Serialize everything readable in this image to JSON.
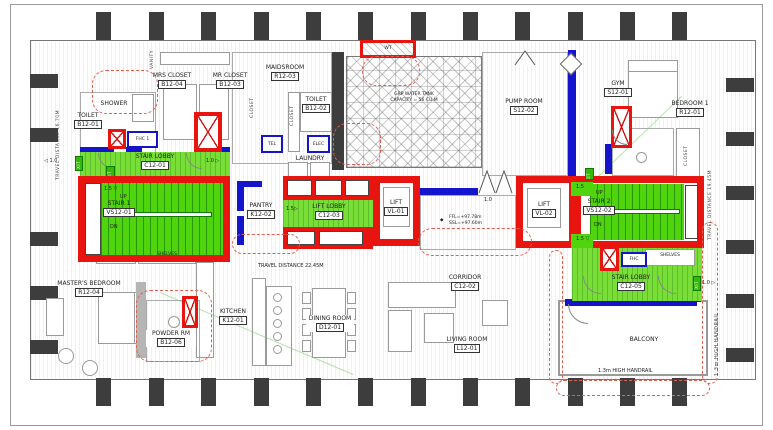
{
  "drawing_type": "residential floor plan - fire egress / life safety layout",
  "colors": {
    "core_red": "#e8140f",
    "egress_green": "#50d40e",
    "wall_blue": "#1414cc",
    "column_gray": "#3d3d3d",
    "revision_cloud_red": "#e06050"
  },
  "rooms": {
    "toilet1": {
      "name": "TOILET",
      "number": "B12-01"
    },
    "shower": {
      "name": "SHOWER"
    },
    "mrs_closet": {
      "name": "MRS CLOSET",
      "number": "B12-04"
    },
    "mr_closet": {
      "name": "MR CLOSET",
      "number": "B12-03"
    },
    "maidsroom": {
      "name": "MAIDSROOM",
      "number": "R12-03"
    },
    "toilet2": {
      "name": "TOILET",
      "number": "B12-02"
    },
    "laundry": {
      "name": "LAUNDRY"
    },
    "water_tank": {
      "line1": "GRP WATER TANK",
      "line2": "CAPACITY = 56 CU.M"
    },
    "pump_room": {
      "name": "PUMP ROOM",
      "number": "S12-02"
    },
    "gym": {
      "name": "GYM",
      "number": "S12-01"
    },
    "bedroom1": {
      "name": "BEDROOM 1",
      "number": "R12-01"
    },
    "pantry": {
      "name": "PANTRY",
      "number": "K12-02"
    },
    "lift_lobby": {
      "name": "LIFT LOBBY",
      "number": "C12-03"
    },
    "lift1": {
      "name": "LIFT",
      "number": "VL-01"
    },
    "lift2": {
      "name": "LIFT",
      "number": "VL-02"
    },
    "stair1": {
      "name": "STAIR 1",
      "number": "VS12-01"
    },
    "stair2": {
      "name": "STAIR 2",
      "number": "VS12-02"
    },
    "stair_lobby1": {
      "name": "STAIR LOBBY",
      "number": "C12-01"
    },
    "stair_lobby2": {
      "name": "STAIR LOBBY",
      "number": "C12-05"
    },
    "corridor": {
      "name": "CORRIDOR",
      "number": "C12-02"
    },
    "living": {
      "name": "LIVING ROOM",
      "number": "L12-01"
    },
    "dining": {
      "name": "DINING ROOM",
      "number": "D12-01"
    },
    "kitchen": {
      "name": "KITCHEN",
      "number": "K12-01"
    },
    "master": {
      "name": "MASTER'S BEDROOM",
      "number": "R12-04"
    },
    "powder": {
      "name": "POWDER RM",
      "number": "B12-06"
    },
    "balcony": {
      "name": "BALCONY"
    }
  },
  "equipment": {
    "fhc1": "FHC 1",
    "fhc2": "FHC",
    "tel": "TEL",
    "elec": "ELEC",
    "shelves": "SHELVES",
    "wt": "WT",
    "vanity": "VANITY",
    "closet": "CLOSET"
  },
  "stairs": {
    "up": "UP",
    "dn": "DN",
    "exit": "EXIT"
  },
  "annotations": {
    "travel_left": "TRAVEL DISTANCE 16.70M",
    "travel_center": "TRAVEL DISTANCE 22.45M",
    "travel_right": "TRAVEL DISTANCE 19.45M",
    "handrail_bottom": "1.3m HIGH HANDRAIL",
    "handrail_right": "1.3m HIGH HANDRAIL",
    "ffl": "FFL=+97.78m",
    "ssl": "SSL=+97.60m"
  },
  "egress_widths": {
    "w10": "1.0",
    "w15": "1.5"
  },
  "icons": {
    "arrow_left": "◁",
    "arrow_right": "▷",
    "arrow_down": "▽",
    "marker_diamond": "◆"
  }
}
